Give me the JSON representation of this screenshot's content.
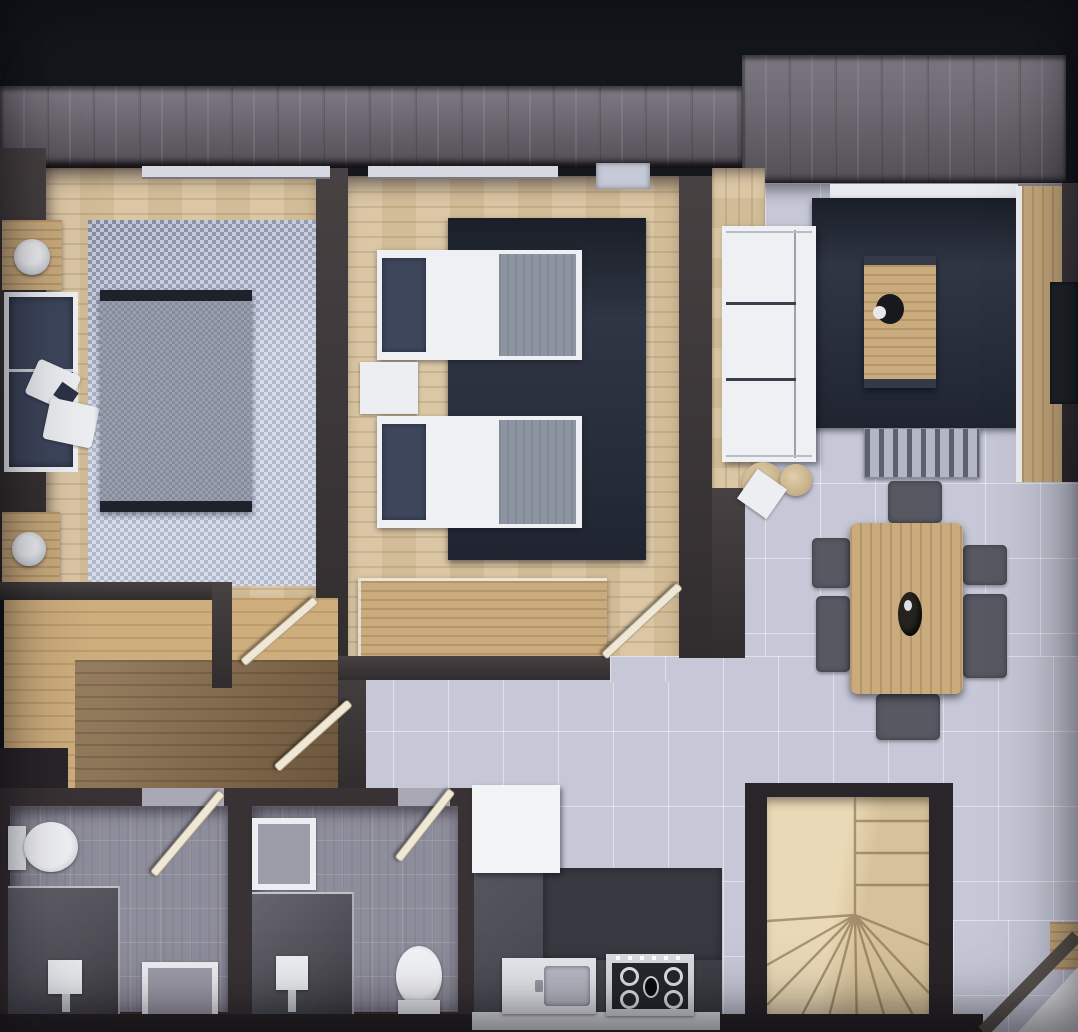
{
  "palette": {
    "bg": "#14171c",
    "band": "#716c77",
    "wall": "#3d3738",
    "wallDeep": "#2a2529",
    "woodFloor": "#d9c49f",
    "hallWoodLight": "#cfae7e",
    "hallWoodDark": "#8a6e4c",
    "tile": "#c6c8d7",
    "bathTile": "#8e8d9b",
    "bathWall": "#383234",
    "navyRug": "#272e3c",
    "checkRug": "#b2bad0",
    "bedThrow": "#99a0b0",
    "bedEndDark": "#1e222b",
    "linenWhite": "#eef0f4",
    "pillowNavy": "#3e465c",
    "blanketGray": "#8e95a2",
    "furnWood": "#c9ab7e",
    "stairWood": "#d6c29a",
    "stairWoodLight": "#ead9b6",
    "chairGray": "#585863",
    "showerDark": "#55545e",
    "kitchenFloor": "#4a4c55",
    "counterDark": "#383a42",
    "cooktopDark": "#26282e",
    "applianceWhite": "#eceef2",
    "doorLeaf": "#efe8d6",
    "poufTan": "#c9b189",
    "benchGray": "#b3b6c3",
    "panelDark": "#22262c",
    "cornerLight": "#f2f3f5"
  },
  "rooms": [
    {
      "name": "bedroom-1",
      "furniture": [
        "double-bed",
        "daybed",
        "pillows",
        "nightstand",
        "nightstand",
        "ottoman",
        "ottoman",
        "checkered-rug"
      ]
    },
    {
      "name": "bedroom-2",
      "furniture": [
        "single-bed",
        "single-bed",
        "nightstand",
        "dresser",
        "dark-rug"
      ]
    },
    {
      "name": "living-dining-room",
      "furniture": [
        "sofa",
        "coffee-table",
        "media-bench",
        "side-table",
        "pouf",
        "pouf",
        "dining-table",
        "dining-chairs-x6",
        "sideboard",
        "wall-panel",
        "dark-rug"
      ]
    },
    {
      "name": "hallway",
      "furniture": [
        "door-leaf",
        "door-leaf"
      ]
    },
    {
      "name": "bathroom-1",
      "furniture": [
        "toilet",
        "shower",
        "washbasin",
        "vanity",
        "door-leaf"
      ]
    },
    {
      "name": "bathroom-2",
      "furniture": [
        "vanity",
        "shower",
        "washbasin",
        "toilet",
        "door-leaf"
      ]
    },
    {
      "name": "kitchen",
      "furniture": [
        "counter",
        "sink",
        "cooktop",
        "tall-cabinet"
      ]
    },
    {
      "name": "staircase",
      "furniture": [
        "winder-stairs"
      ]
    }
  ]
}
